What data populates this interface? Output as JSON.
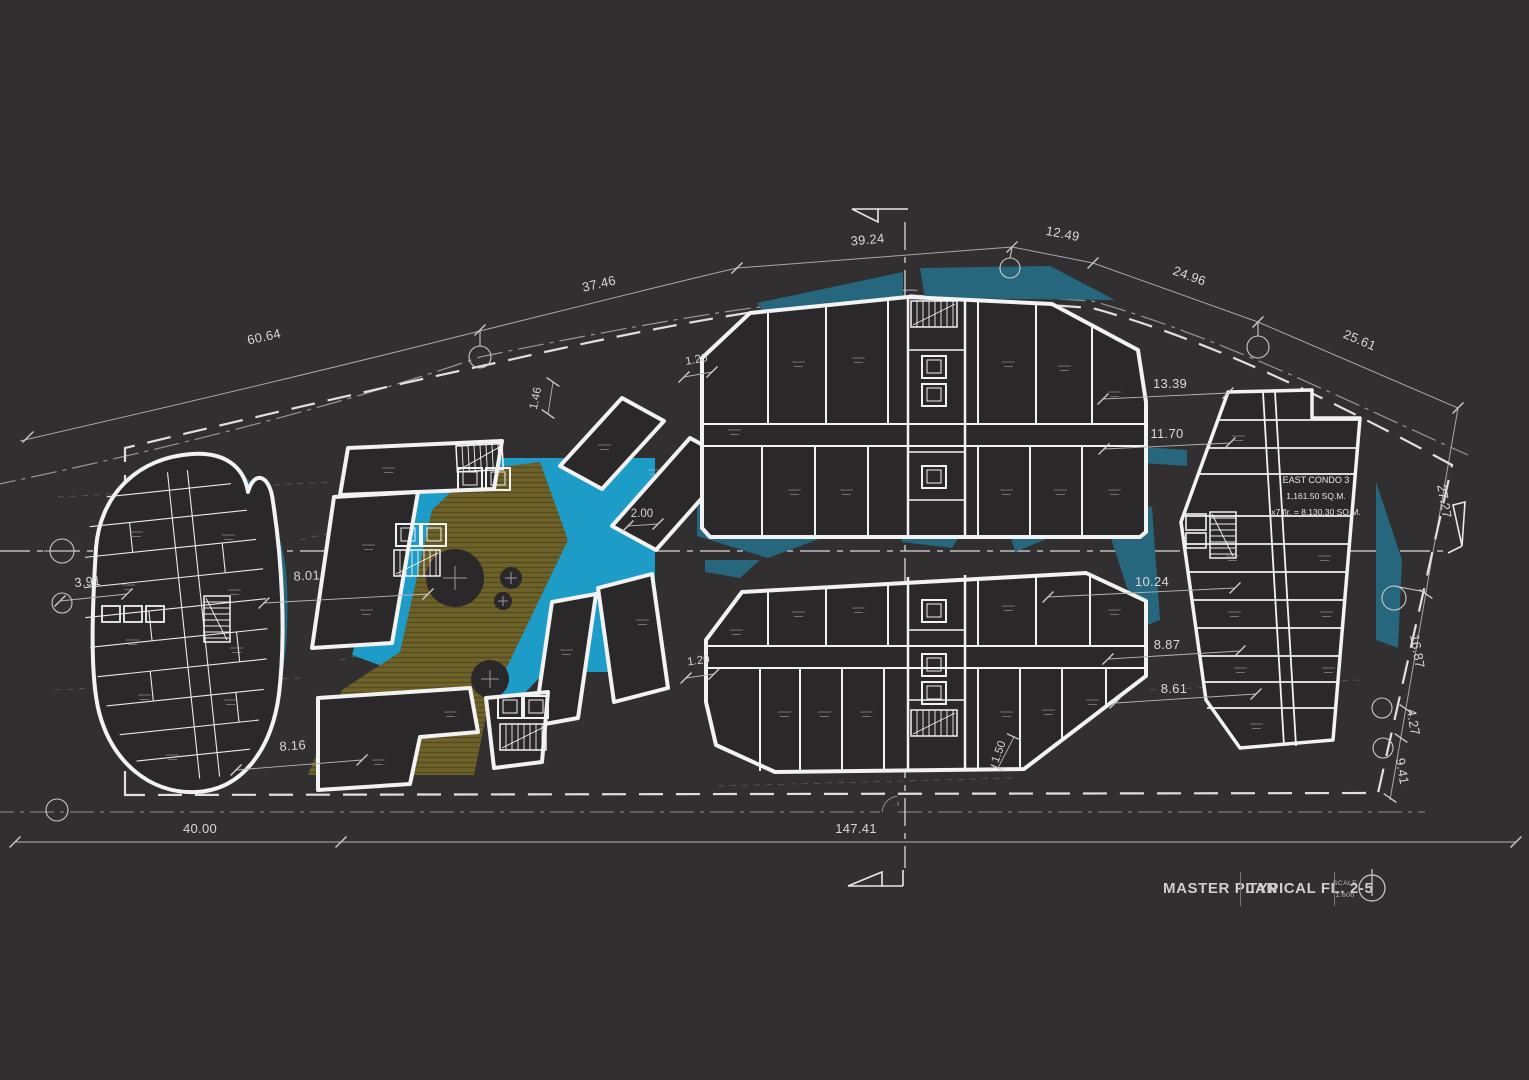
{
  "title_block": {
    "title": "MASTER PLAN",
    "subtitle": "TYPICAL FL. 2-5",
    "scale_label": "SCALE",
    "scale_value": "1:600"
  },
  "annotations": {
    "east_condo_name": "EAST CONDO 3",
    "east_condo_area": "1,161.50 SQ.M.",
    "east_condo_total": "x7 flr. = 8,130.30 SQ.M."
  },
  "dimensions": {
    "top_1": "60.64",
    "top_2": "37.46",
    "top_3": "39.24",
    "top_4": "12.49",
    "top_5": "24.96",
    "top_6": "25.61",
    "right_1": "27.27",
    "right_2": "16.87",
    "right_3": "4.27",
    "right_4": "9.41",
    "east_1": "13.39",
    "east_2": "11.70",
    "east_3": "10.24",
    "east_4": "8.87",
    "east_5": "8.61",
    "left_1": "3.91",
    "left_2": "8.01",
    "left_3": "8.16",
    "bottom_1": "40.00",
    "bottom_2": "147.41",
    "small_gap_top": "1.20",
    "small_setback": "1.46",
    "small_pool": "2.00",
    "small_gap_bottom": "1.20",
    "small_corner": "1.50"
  },
  "colors": {
    "background": "#312f2f",
    "building_fill": "#2a2828",
    "line_white": "#f2f2f2",
    "pool_blue": "#1e9cc8",
    "water_teal": "#26677e",
    "deck_olive": "#6f6229",
    "dim_text": "#d8d8d8"
  }
}
